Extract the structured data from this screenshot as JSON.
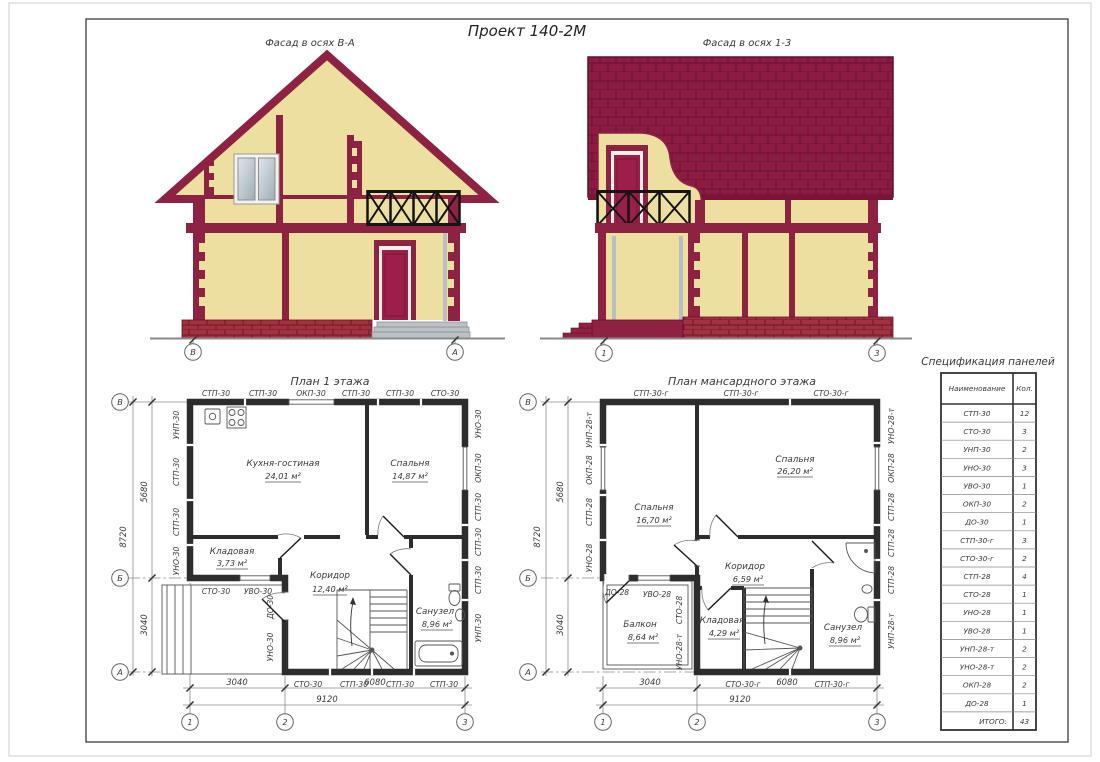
{
  "sheet": {
    "title": "Проект 140-2М"
  },
  "facades": {
    "left": {
      "label": "Фасад в осях В-А",
      "axis_left": "В",
      "axis_right": "А"
    },
    "right": {
      "label": "Фасад в осях 1-3",
      "axis_left": "1",
      "axis_right": "3"
    }
  },
  "plan1": {
    "title": "План 1 этажа",
    "panels": {
      "top": [
        "СТП-30",
        "СТП-30",
        "ОКП-30",
        "СТП-30",
        "СТП-30",
        "СТО-30"
      ],
      "bottom": [
        "СТО-30",
        "СТП-30",
        "СТП-30",
        "СТП-30"
      ],
      "left": [
        "УНП-30",
        "СТП-30",
        "СТП-30",
        "УНО-30"
      ],
      "right": [
        "УНО-30",
        "ОКП-30",
        "СТП-30",
        "СТП-30",
        "СТП-30",
        "УНП-30"
      ],
      "inner": [
        "СТО-30",
        "УВО-30",
        "ДО-30",
        "УНО-30"
      ]
    },
    "rooms": [
      {
        "name": "Кухня-гостиная",
        "area": "24,01 м²"
      },
      {
        "name": "Спальня",
        "area": "14,87 м²"
      },
      {
        "name": "Кладовая",
        "area": "3,73 м²"
      },
      {
        "name": "Коридор",
        "area": "12,40 м²"
      },
      {
        "name": "Санузел",
        "area": "8,96 м²"
      }
    ],
    "dims": {
      "height_total": "8720",
      "height_top": "5680",
      "height_bottom": "3040",
      "width_left": "3040",
      "width_right": "6080",
      "width_total": "9120"
    },
    "axes": {
      "rows": [
        "В",
        "Б",
        "А"
      ],
      "cols": [
        "1",
        "2",
        "3"
      ]
    }
  },
  "plan2": {
    "title": "План мансардного этажа",
    "panels": {
      "top": [
        "СТП-30-г",
        "СТП-30-г",
        "СТО-30-г"
      ],
      "bottom": [
        "СТО-30-г",
        "СТП-30-г"
      ],
      "left": [
        "УНП-28-т",
        "ОКП-28",
        "СТП-28",
        "УНО-28"
      ],
      "right": [
        "УНО-28-т",
        "ОКП-28",
        "СТП-28",
        "СТП-28",
        "СТП-28",
        "УНП-28-т"
      ],
      "inner": [
        "ДО-28",
        "УВО-28",
        "СТО-28",
        "УНО-28-т"
      ]
    },
    "rooms": [
      {
        "name": "Спальня",
        "area": "26,20 м²"
      },
      {
        "name": "Спальня",
        "area": "16,70 м²"
      },
      {
        "name": "Коридор",
        "area": "6,59 м²"
      },
      {
        "name": "Балкон",
        "area": "8,64 м²"
      },
      {
        "name": "Кладовая",
        "area": "4,29 м²"
      },
      {
        "name": "Санузел",
        "area": "8,96 м²"
      }
    ],
    "dims": {
      "height_total": "8720",
      "height_top": "5680",
      "height_bottom": "3040",
      "width_left": "3040",
      "width_right": "6080",
      "width_total": "9120"
    },
    "axes": {
      "rows": [
        "В",
        "Б",
        "А"
      ],
      "cols": [
        "1",
        "2",
        "3"
      ]
    }
  },
  "spec": {
    "title": "Спецификация панелей",
    "headers": [
      "Наименование",
      "Кол."
    ],
    "rows": [
      [
        "СТП-30",
        "12"
      ],
      [
        "СТО-30",
        "3"
      ],
      [
        "УНП-30",
        "2"
      ],
      [
        "УНО-30",
        "3"
      ],
      [
        "УВО-30",
        "1"
      ],
      [
        "ОКП-30",
        "2"
      ],
      [
        "ДО-30",
        "1"
      ],
      [
        "СТП-30-г",
        "3"
      ],
      [
        "СТО-30-г",
        "2"
      ],
      [
        "СТП-28",
        "4"
      ],
      [
        "СТО-28",
        "1"
      ],
      [
        "УНО-28",
        "1"
      ],
      [
        "УВО-28",
        "1"
      ],
      [
        "УНП-28-т",
        "2"
      ],
      [
        "УНО-28-т",
        "2"
      ],
      [
        "ОКП-28",
        "2"
      ],
      [
        "ДО-28",
        "1"
      ],
      [
        "ИТОГО:",
        "43"
      ]
    ]
  },
  "colors": {
    "accent_maroon": "#8e2242",
    "roof_shingle": "#8c1b43",
    "wall_cream": "#ecdf9f",
    "brick": "#a23241",
    "door_crimson": "#9c1f4b",
    "glass_gray": "#c9d3d8",
    "steps_gray": "#bcc1c5",
    "railing_black": "#141414",
    "line_dark": "#2d2d2d"
  }
}
